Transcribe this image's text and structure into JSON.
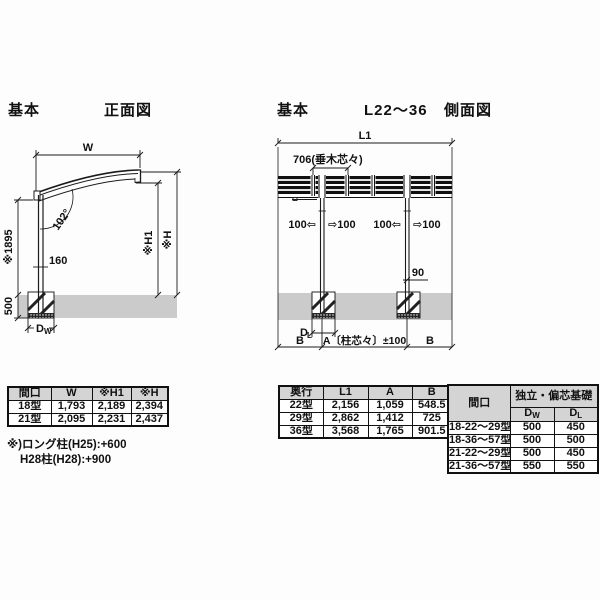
{
  "colors": {
    "ground_gray": "#cbcbcb",
    "table_header_bg": "#d4d4d4",
    "line": "#1a1a1a"
  },
  "front_view": {
    "section_label": "基本",
    "title": "正面図",
    "dims": {
      "w": "W",
      "angle": "102°",
      "h1895": "※1895",
      "d160": "160",
      "d500": "500",
      "dw_main": "D",
      "dw_sub": "W",
      "h1": "※H1",
      "h": "※H"
    }
  },
  "side_view": {
    "section_label": "基本",
    "range_label": "L22〜36",
    "title": "側面図",
    "dims": {
      "l1": "L1",
      "rafter": "706(垂木芯々)",
      "arrow1": "100⇦",
      "arrow2": "⇨100",
      "arrow3": "100⇦",
      "arrow4": "⇨100",
      "d90": "90",
      "dl_main": "D",
      "dl_sub": "L",
      "b_left": "B",
      "a_center": "A〔柱芯々〕±100",
      "b_right": "B"
    }
  },
  "tables": {
    "front": {
      "headers": [
        "間口",
        "W",
        "※H1",
        "※H"
      ],
      "rows": [
        [
          "18型",
          "1,793",
          "2,189",
          "2,394"
        ],
        [
          "21型",
          "2,095",
          "2,231",
          "2,437"
        ]
      ]
    },
    "front_notes": [
      "※)ロング柱(H25):+600",
      "H28柱(H28):+900"
    ],
    "side": {
      "headers": [
        "奥行",
        "L1",
        "A",
        "B"
      ],
      "rows": [
        [
          "22型",
          "2,156",
          "1,059",
          "548.5"
        ],
        [
          "29型",
          "2,862",
          "1,412",
          "725"
        ],
        [
          "36型",
          "3,568",
          "1,765",
          "901.5"
        ]
      ]
    },
    "foundation": {
      "col1_header": "間口",
      "group_header": "独立・偏芯基礎",
      "sub_headers": [
        {
          "main": "D",
          "sub": "W"
        },
        {
          "main": "D",
          "sub": "L"
        }
      ],
      "rows": [
        [
          "18-22〜29型",
          "500",
          "450"
        ],
        [
          "18-36〜57型",
          "500",
          "500"
        ],
        [
          "21-22〜29型",
          "500",
          "450"
        ],
        [
          "21-36〜57型",
          "550",
          "550"
        ]
      ]
    }
  }
}
